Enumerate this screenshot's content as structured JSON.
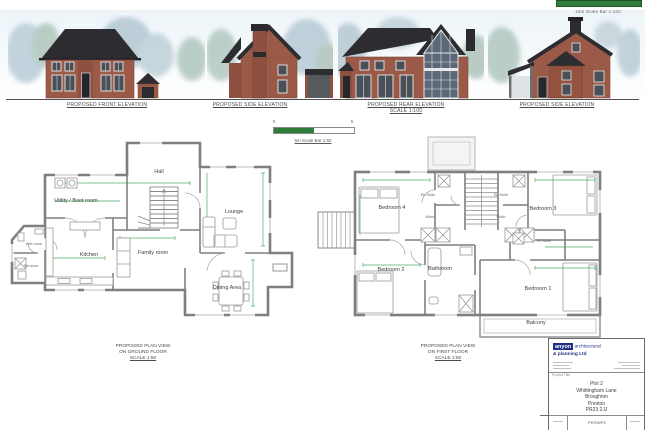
{
  "colors": {
    "scale_bar_green": "#2f7d3a",
    "brick": "#9a5a47",
    "roof": "#2d2d31",
    "dimension_green": "#3aa655",
    "brand_blue": "#1f2f86"
  },
  "elevations": [
    {
      "label": "PROPOSED FRONT ELEVATION",
      "scale": ""
    },
    {
      "label": "PROPOSED SIDE ELEVATION",
      "scale": ""
    },
    {
      "label": "PROPOSED REAR ELEVATION",
      "scale": "SCALE 1:100"
    },
    {
      "label": "PROPOSED SIDE ELEVATION",
      "scale": ""
    }
  ],
  "scale_bars": {
    "top_label": "10m Scale Bar 1:100",
    "mid_label": "5m Scale Bar 1:50",
    "mid_start": "0",
    "mid_end": "5"
  },
  "ground_floor": {
    "title1": "PROPOSED PLAN VIEW",
    "title2": "ON GROUND FLOOR",
    "title3": "SCALE 1:50",
    "rooms": {
      "hall": "Hall",
      "utility": "Utility / Boot room",
      "wet_room": "Wet room",
      "services": "Services",
      "kitchen": "Kitchen",
      "family": "Family room",
      "lounge": "Lounge",
      "dining": "Dining Area"
    }
  },
  "first_floor": {
    "title1": "PROPOSED PLAN VIEW",
    "title2": "ON FIRST FLOOR",
    "title3": "SCALE 1:50",
    "rooms": {
      "bedroom4": "Bedroom 4",
      "ensuite_left": "En Suite",
      "ensuite_right": "En Suite",
      "bedroom3": "Bedroom 3",
      "wdrb_left": "Wdrb",
      "wdrb_right": "Wdrb",
      "bedroom2": "Bedroom 2",
      "bathroom": "Bathroom",
      "ensuite_mid": "En Suite",
      "bedroom1": "Bedroom 1",
      "balcony": "Balcony"
    }
  },
  "title_block": {
    "brand": "anyon",
    "brand_suffix": "architectural",
    "brand_line2": "& planning Ltd",
    "project_label": "Project Title",
    "address1": "Plot 2",
    "address2": "Whittingham Lane",
    "address3": "Broughton",
    "address4": "Preston",
    "address5": "PR23 2JJ",
    "drawing_number": "P0709/P2"
  }
}
